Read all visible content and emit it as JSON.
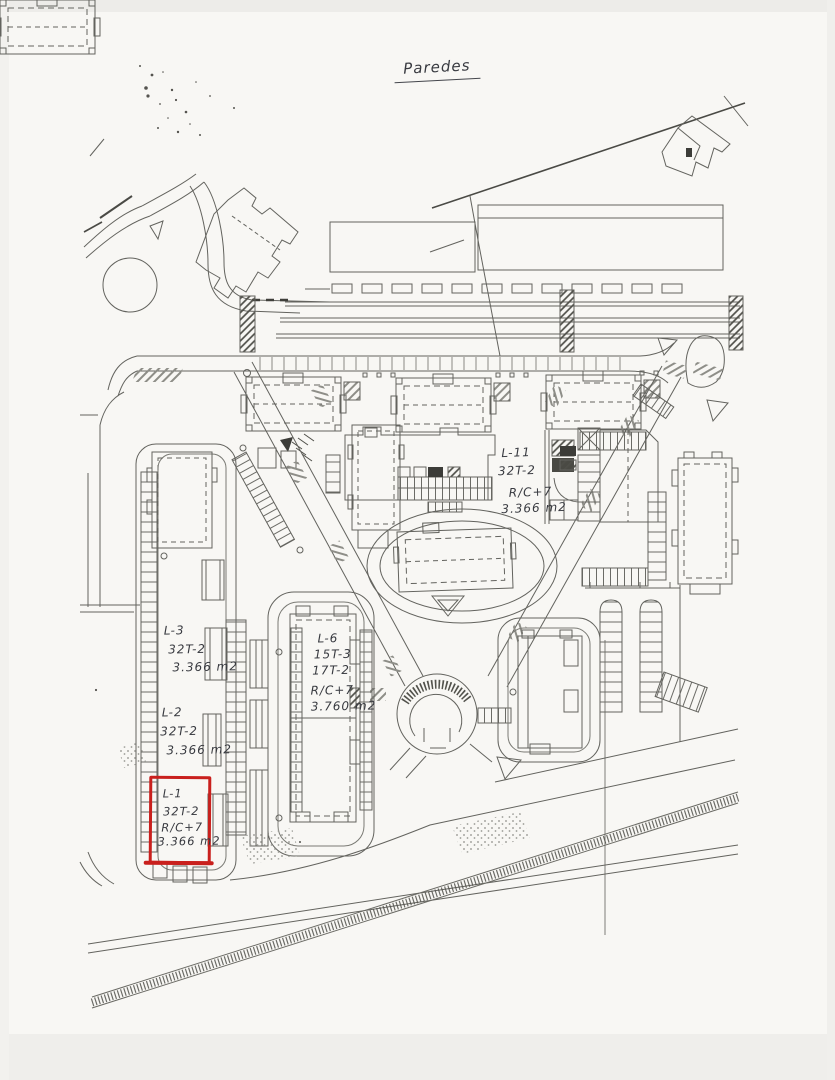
{
  "page": {
    "title": "Paredes",
    "highlight_color": "#c9201d",
    "ink_color": "#3f4044"
  },
  "lots": {
    "l11": {
      "lines": [
        "L-11",
        "32T-2",
        "R/C+7",
        "3.366 m2"
      ]
    },
    "l6": {
      "lines": [
        "L-6",
        "15T-3",
        "17T-2",
        "R/C+7",
        "3.760 m2"
      ]
    },
    "l3": {
      "lines": [
        "L-3",
        "32T-2",
        "3.366 m2"
      ]
    },
    "l2": {
      "lines": [
        "L-2",
        "32T-2",
        "3.366 m2"
      ]
    },
    "l1": {
      "lines": [
        "L-1",
        "32T-2",
        "R/C+7",
        "3.366 m2"
      ]
    }
  }
}
